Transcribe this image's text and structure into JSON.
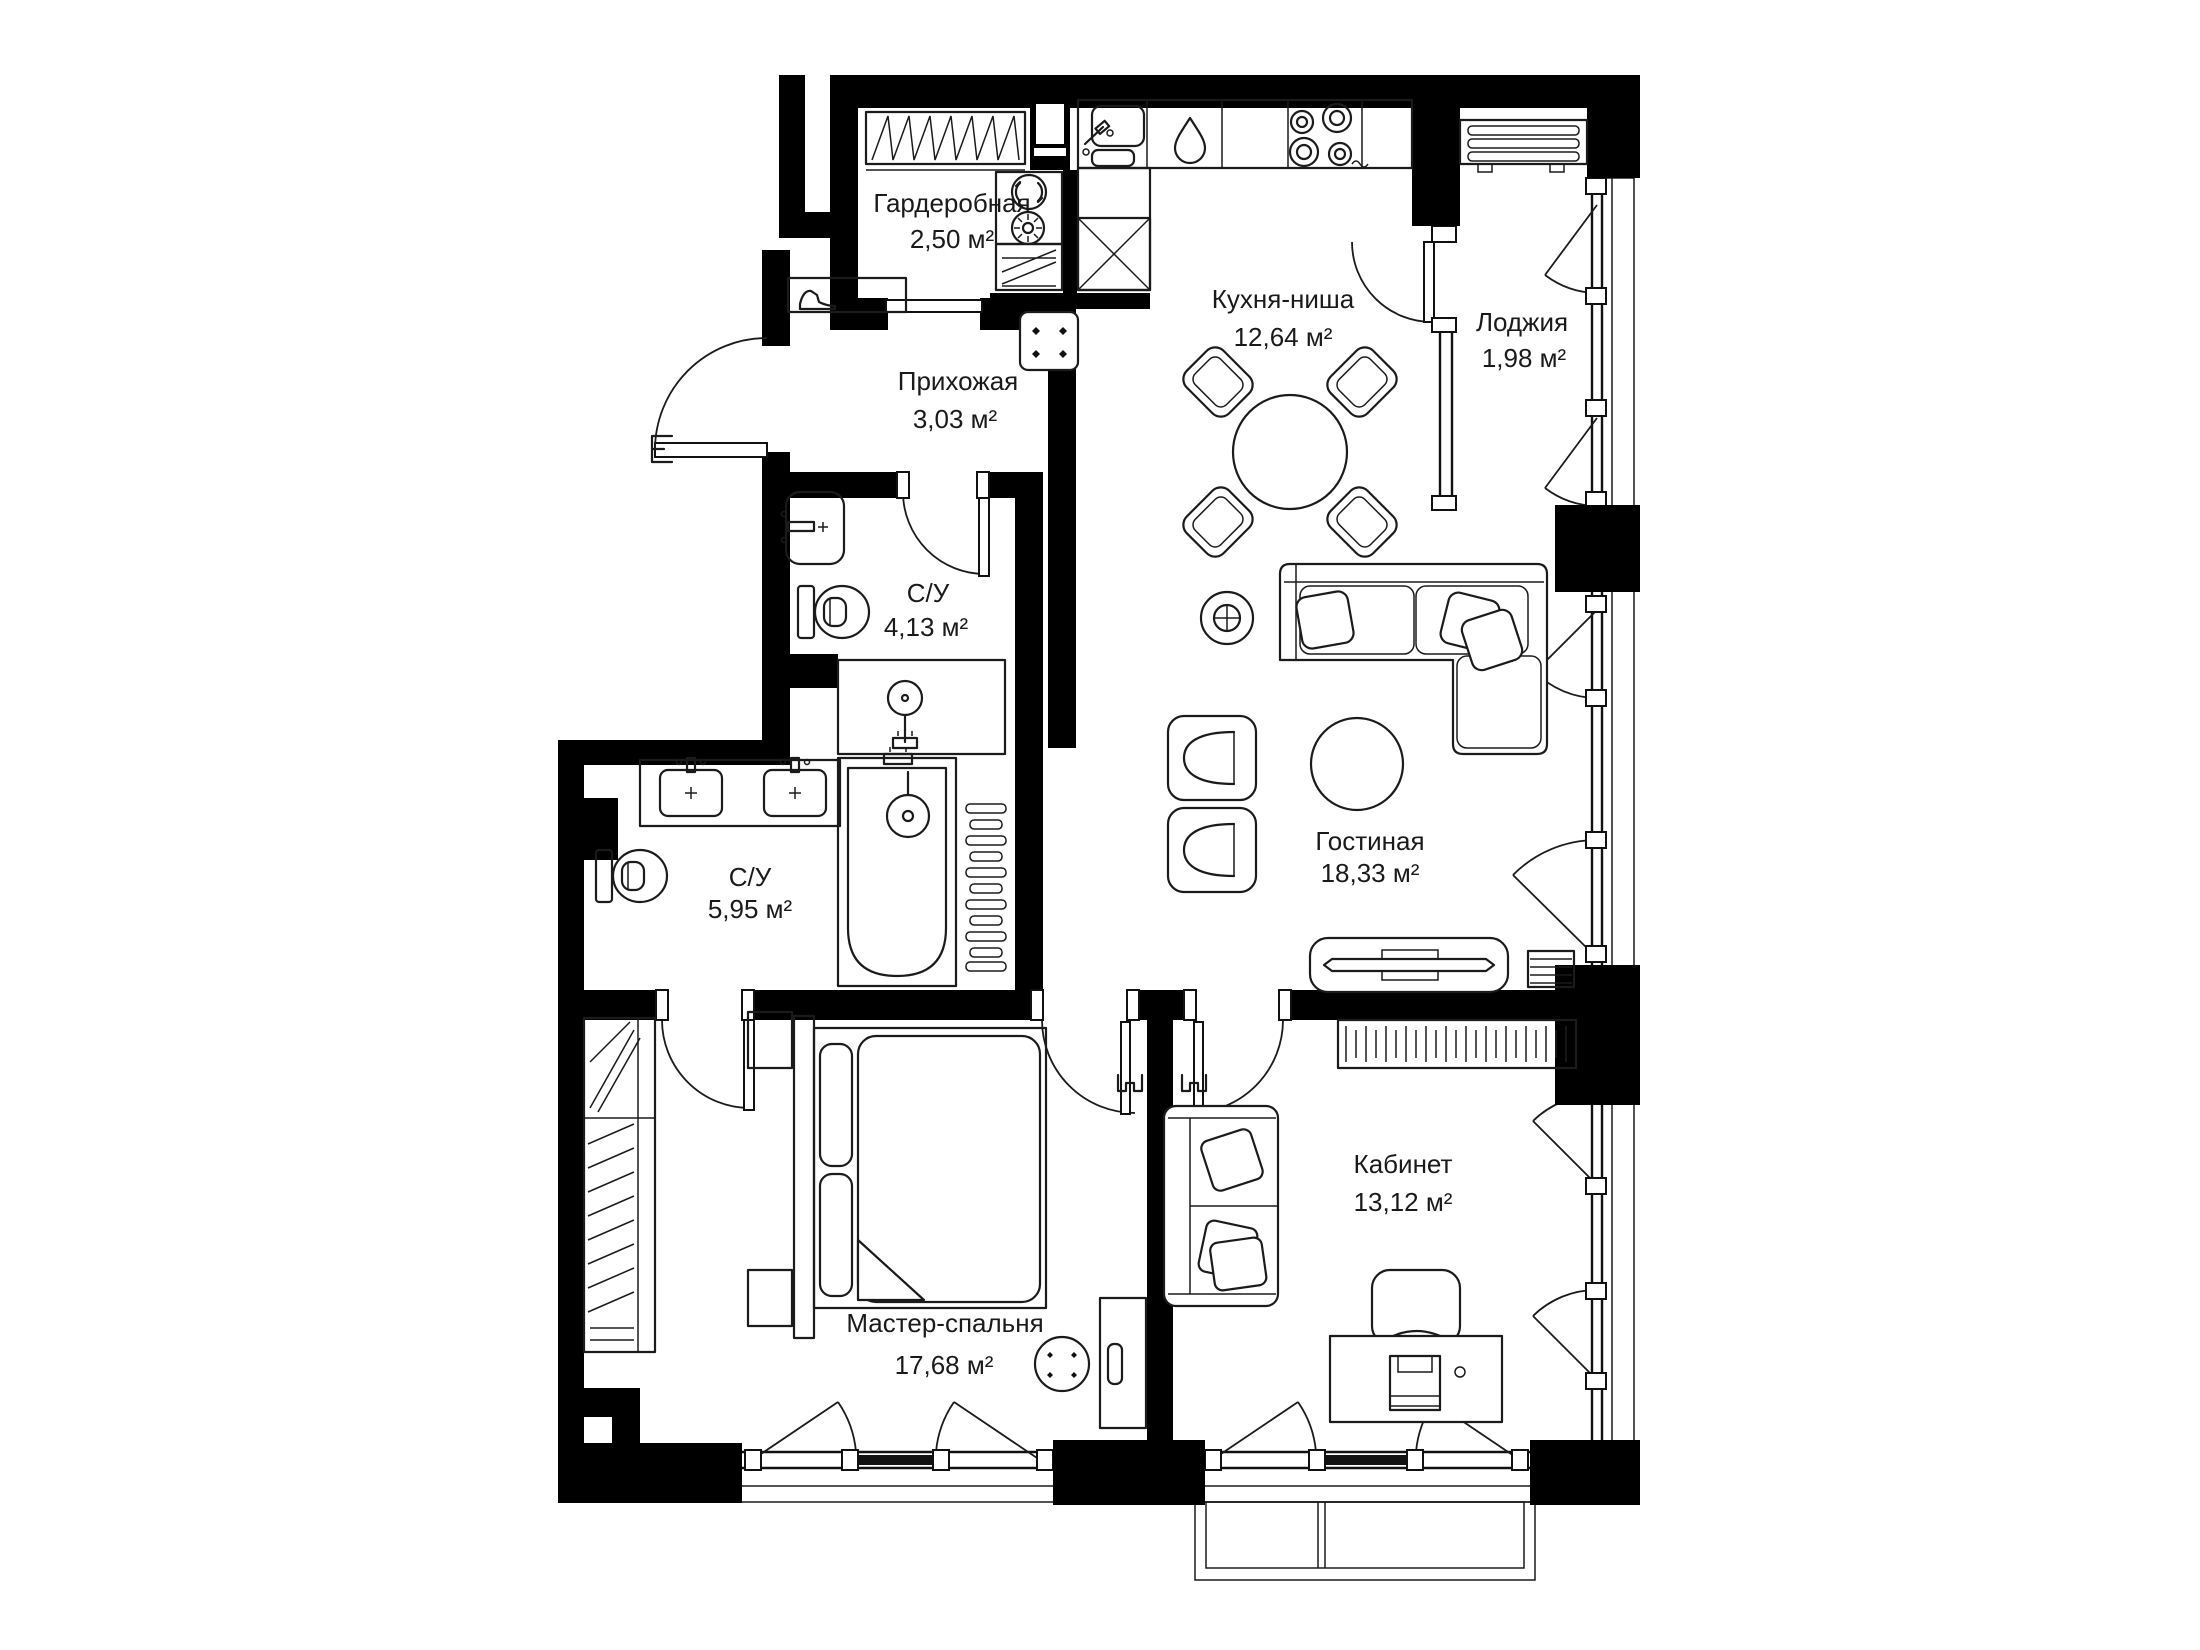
{
  "plan": {
    "background": "#ffffff",
    "wall_color": "#000000",
    "line_color": "#1b1b1b",
    "rooms": [
      {
        "id": "wardrobe",
        "label": "Гардеробная",
        "area": "2,50 м²"
      },
      {
        "id": "hallway",
        "label": "Прихожая",
        "area": "3,03 м²"
      },
      {
        "id": "kitchen",
        "label": "Кухня-ниша",
        "area": "12,64 м²"
      },
      {
        "id": "loggia",
        "label": "Лоджия",
        "area": "1,98 м²"
      },
      {
        "id": "bathroom_small",
        "label": "С/У",
        "area": "4,13 м²"
      },
      {
        "id": "bathroom_master",
        "label": "С/У",
        "area": "5,95 м²"
      },
      {
        "id": "living",
        "label": "Гостиная",
        "area": "18,33 м²"
      },
      {
        "id": "master_bedroom",
        "label": "Мастер-спальня",
        "area": "17,68 м²"
      },
      {
        "id": "study",
        "label": "Кабинет",
        "area": "13,12 м²"
      }
    ]
  }
}
